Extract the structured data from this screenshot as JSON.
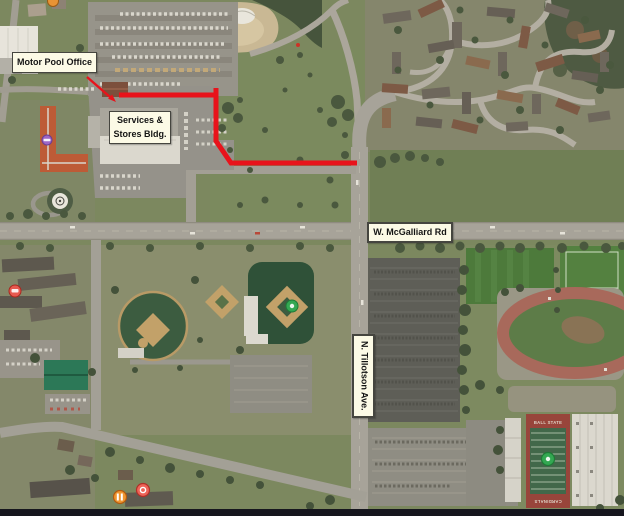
{
  "figure": {
    "callouts": {
      "motor_pool": "Motor Pool Office",
      "services_line1": "Services &",
      "services_line2": "Stores Bldg.",
      "mcgalliard": "W. McGalliard Rd",
      "tillotson": "N. Tillotson Ave."
    },
    "route_color": "#e8131b",
    "callout_style": {
      "bg": "#fcfae6",
      "border": "#45453f"
    },
    "stadium_text": {
      "north_endzone": "BALL STATE",
      "south_endzone": "CARDINALS"
    },
    "markers": [
      {
        "id": "poi-top-edge",
        "color": "#e89335"
      },
      {
        "id": "poi-hotel-logo",
        "color": "#9d66c6"
      },
      {
        "id": "poi-lodging-west",
        "color": "#e85a50"
      },
      {
        "id": "poi-ballpark",
        "color": "#33a852"
      },
      {
        "id": "poi-restaurant",
        "color": "#ef9530"
      },
      {
        "id": "poi-food-south",
        "color": "#ef6458"
      },
      {
        "id": "poi-stadium-field",
        "color": "#33a852"
      },
      {
        "id": "poi-small-dot",
        "color": "#cc3326"
      }
    ]
  }
}
